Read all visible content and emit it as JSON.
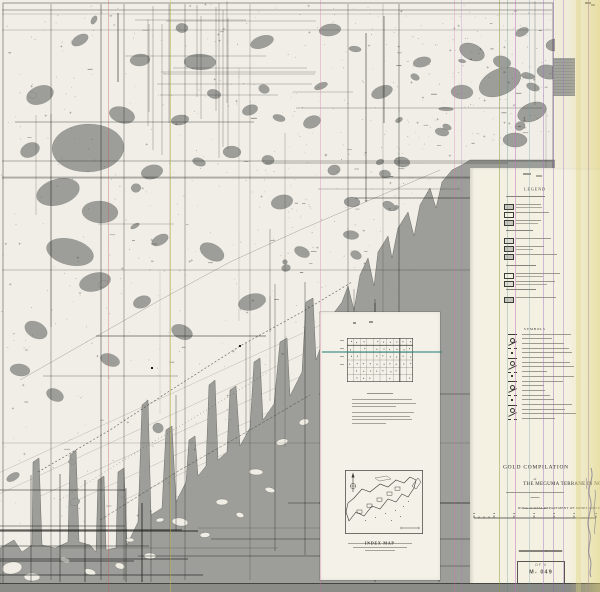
{
  "document": {
    "kind": "scanned geological compilation map sheet",
    "region_depicted": "Atlantic coast of Nova Scotia with indented bays and inland lakes"
  },
  "title_block": {
    "line1": "GOLD COMPILATION",
    "connector": "of",
    "line2": "THE MEGUMA TERRANE IN NOVA SCOTIA",
    "department": "NOVA SCOTIA DEPARTMENT OF MINES AND ENERGY"
  },
  "legend": {
    "heading": "LEGEND",
    "symbols_heading": "SYMBOLS",
    "section1_rows": 13,
    "section2_rows": 19
  },
  "inset": {
    "index_map_label": "INDEX MAP",
    "grid_cols": 10,
    "grid_rows": 6,
    "caption_lines": 3
  },
  "stamp": {
    "line1": "OF V",
    "line2": "M- 049"
  },
  "colors": {
    "ocean": "#9d9d99",
    "land": "#f0eee6",
    "panel": "#f4f1e3",
    "margin_top": "#f1ecd9",
    "inset_panel": "#f4f2e8",
    "bottom_strip": "#8b8b87",
    "ink": "#1e1e1c",
    "teal_artifact": "#2f837d"
  },
  "render": {
    "seed": 7,
    "coast": [
      [
        0,
        548
      ],
      [
        14,
        540
      ],
      [
        22,
        552
      ],
      [
        32,
        545
      ],
      [
        33,
        462
      ],
      [
        39,
        458
      ],
      [
        42,
        545
      ],
      [
        55,
        548
      ],
      [
        68,
        542
      ],
      [
        70,
        455
      ],
      [
        76,
        450
      ],
      [
        79,
        542
      ],
      [
        90,
        545
      ],
      [
        96,
        552
      ],
      [
        98,
        480
      ],
      [
        104,
        476
      ],
      [
        106,
        550
      ],
      [
        116,
        548
      ],
      [
        118,
        472
      ],
      [
        124,
        468
      ],
      [
        127,
        545
      ],
      [
        138,
        522
      ],
      [
        142,
        405
      ],
      [
        148,
        400
      ],
      [
        151,
        515
      ],
      [
        162,
        508
      ],
      [
        166,
        430
      ],
      [
        172,
        426
      ],
      [
        176,
        502
      ],
      [
        186,
        482
      ],
      [
        189,
        440
      ],
      [
        195,
        436
      ],
      [
        198,
        476
      ],
      [
        206,
        466
      ],
      [
        209,
        385
      ],
      [
        215,
        380
      ],
      [
        218,
        460
      ],
      [
        227,
        452
      ],
      [
        230,
        390
      ],
      [
        236,
        386
      ],
      [
        240,
        446
      ],
      [
        250,
        428
      ],
      [
        254,
        362
      ],
      [
        260,
        358
      ],
      [
        263,
        420
      ],
      [
        274,
        404
      ],
      [
        280,
        342
      ],
      [
        287,
        338
      ],
      [
        290,
        396
      ],
      [
        302,
        372
      ],
      [
        306,
        302
      ],
      [
        313,
        298
      ],
      [
        316,
        360
      ],
      [
        324,
        338
      ],
      [
        330,
        318
      ],
      [
        342,
        302
      ],
      [
        348,
        286
      ],
      [
        354,
        310
      ],
      [
        360,
        275
      ],
      [
        368,
        258
      ],
      [
        374,
        286
      ],
      [
        378,
        252
      ],
      [
        388,
        236
      ],
      [
        392,
        258
      ],
      [
        398,
        228
      ],
      [
        408,
        212
      ],
      [
        414,
        236
      ],
      [
        420,
        205
      ],
      [
        430,
        188
      ],
      [
        436,
        208
      ],
      [
        442,
        182
      ],
      [
        452,
        170
      ],
      [
        462,
        165
      ],
      [
        470,
        160
      ],
      [
        600,
        160
      ],
      [
        600,
        592
      ],
      [
        0,
        592
      ]
    ],
    "lakes": [
      [
        88,
        148,
        36,
        24
      ],
      [
        58,
        192,
        22,
        13
      ],
      [
        100,
        212,
        18,
        11
      ],
      [
        70,
        252,
        24,
        13
      ],
      [
        95,
        282,
        16,
        9
      ],
      [
        40,
        95,
        14,
        9
      ],
      [
        122,
        115,
        13,
        8
      ],
      [
        200,
        62,
        16,
        8
      ],
      [
        262,
        42,
        12,
        6
      ],
      [
        330,
        30,
        11,
        6
      ],
      [
        152,
        172,
        11,
        7
      ],
      [
        232,
        152,
        9,
        6
      ],
      [
        282,
        202,
        11,
        7
      ],
      [
        212,
        252,
        13,
        8
      ],
      [
        252,
        302,
        14,
        8
      ],
      [
        182,
        332,
        11,
        7
      ],
      [
        142,
        302,
        9,
        6
      ],
      [
        312,
        122,
        9,
        6
      ],
      [
        382,
        92,
        11,
        6
      ],
      [
        422,
        62,
        9,
        5
      ],
      [
        462,
        92,
        11,
        7
      ],
      [
        502,
        62,
        9,
        6
      ],
      [
        522,
        32,
        7,
        4
      ],
      [
        302,
        252,
        8,
        5
      ],
      [
        352,
        202,
        8,
        5
      ],
      [
        402,
        162,
        8,
        5
      ],
      [
        442,
        132,
        7,
        4
      ],
      [
        36,
        330,
        12,
        8
      ],
      [
        20,
        370,
        10,
        6
      ],
      [
        55,
        395,
        9,
        6
      ],
      [
        110,
        360,
        10,
        6
      ],
      [
        160,
        240,
        9,
        5
      ],
      [
        250,
        110,
        8,
        5
      ],
      [
        180,
        120,
        9,
        5
      ],
      [
        140,
        60,
        10,
        6
      ],
      [
        80,
        40,
        9,
        5
      ],
      [
        30,
        150,
        10,
        7
      ]
    ],
    "ocean_blobs": [
      [
        500,
        82,
        22,
        13
      ],
      [
        532,
        112,
        15,
        9
      ],
      [
        472,
        52,
        13,
        8
      ],
      [
        548,
        72,
        11,
        7
      ],
      [
        515,
        140,
        12,
        7
      ],
      [
        555,
        45,
        9,
        6
      ]
    ],
    "islands": [
      [
        180,
        522,
        8,
        4
      ],
      [
        222,
        502,
        6,
        3
      ],
      [
        256,
        472,
        7,
        3
      ],
      [
        150,
        556,
        6,
        3
      ],
      [
        120,
        566,
        5,
        3
      ],
      [
        90,
        572,
        6,
        3
      ],
      [
        282,
        442,
        6,
        3
      ],
      [
        304,
        422,
        5,
        3
      ],
      [
        12,
        568,
        10,
        6
      ],
      [
        32,
        577,
        8,
        4
      ],
      [
        205,
        535,
        5,
        2.5
      ],
      [
        240,
        515,
        4,
        2.5
      ],
      [
        270,
        490,
        5,
        2.5
      ],
      [
        130,
        540,
        4,
        2
      ],
      [
        65,
        560,
        5,
        2.5
      ],
      [
        160,
        520,
        4,
        2
      ]
    ],
    "roads": [
      {
        "pts": "38,472 110,430 168,392 240,346 302,312 352,282",
        "dash": "2,2",
        "w": 0.7,
        "o": 0.65
      },
      {
        "pts": "60,500 140,450 210,408 268,372",
        "dash": "1,2.5",
        "w": 0.5,
        "o": 0.6
      },
      {
        "pts": "20,380 90,340 160,300 230,262 300,230 370,200 440,170",
        "dash": "",
        "w": 0.5,
        "o": 0.4
      },
      {
        "pts": "100,520 180,470 250,430 310,395",
        "dash": "3,1.5",
        "w": 0.6,
        "o": 0.5
      }
    ],
    "artifact_vlines": [
      {
        "x": 108,
        "color": "#c05858",
        "opacity": 0.35,
        "w": 1
      },
      {
        "x": 170,
        "color": "#cfc24e",
        "opacity": 0.45,
        "w": 1
      },
      {
        "x": 320,
        "color": "#d06aa0",
        "opacity": 0.3,
        "w": 1
      },
      {
        "x": 454,
        "color": "#e070b0",
        "opacity": 0.3,
        "w": 1
      },
      {
        "x": 461,
        "color": "#b070c0",
        "opacity": 0.25,
        "w": 1
      },
      {
        "x": 499,
        "color": "#8a9a40",
        "opacity": 0.5,
        "w": 1
      },
      {
        "x": 507,
        "color": "#4a8a80",
        "opacity": 0.3,
        "w": 1
      },
      {
        "x": 515,
        "color": "#c070c0",
        "opacity": 0.5,
        "w": 1
      },
      {
        "x": 529,
        "color": "#70a0b0",
        "opacity": 0.35,
        "w": 1
      },
      {
        "x": 543,
        "color": "#a070c0",
        "opacity": 0.45,
        "w": 1
      },
      {
        "x": 553,
        "color": "#9060b0",
        "opacity": 0.4,
        "w": 1
      },
      {
        "x": 563,
        "color": "#a070c0",
        "opacity": 0.4,
        "w": 1
      },
      {
        "x": 576,
        "color": "#ded47e",
        "opacity": 0.35,
        "w": 5
      },
      {
        "x": 588,
        "color": "#9868b4",
        "opacity": 0.5,
        "w": 1
      }
    ],
    "artifact_hlines": [
      {
        "y": 351,
        "x1": 322,
        "x2": 442,
        "color": "#2f837d",
        "opacity": 0.55,
        "h": 1.5
      }
    ]
  }
}
